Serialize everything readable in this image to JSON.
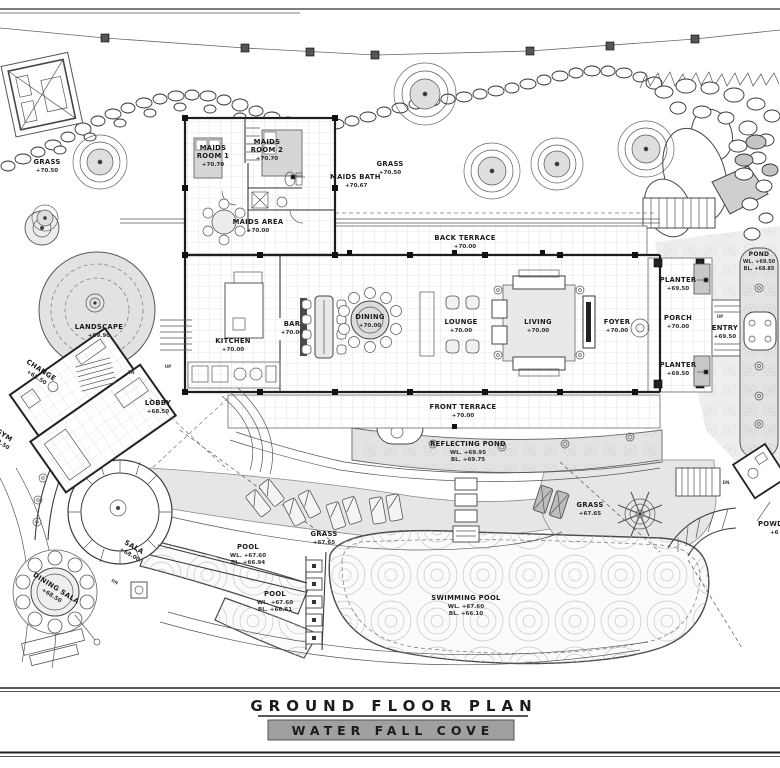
{
  "sheet": {
    "title": "GROUND FLOOR PLAN",
    "subtitle": "WATER FALL COVE"
  },
  "labels": {
    "grass_nw": {
      "name": "GRASS",
      "level": "+70.50"
    },
    "grass_n": {
      "name": "GRASS",
      "level": "+70.50"
    },
    "maids_room_1": {
      "line1": "MAIDS",
      "line2": "ROOM 1",
      "level": "+70.70"
    },
    "maids_room_2": {
      "line1": "MAIDS",
      "line2": "ROOM 2",
      "level": "+70.70"
    },
    "maids_bath": {
      "name": "MAIDS BATH",
      "level": "+70.67"
    },
    "maids_area": {
      "name": "MAIDS AREA",
      "level": "+70.00"
    },
    "back_terrace": {
      "name": "BACK TERRACE",
      "level": "+70.00"
    },
    "pond": {
      "name": "POND",
      "wl": "WL. +69.50",
      "bl": "BL. +68.85"
    },
    "planter_n": {
      "name": "PLANTER",
      "level": "+69.50"
    },
    "porch": {
      "name": "PORCH",
      "level": "+70.00"
    },
    "entry": {
      "name": "ENTRY",
      "level": "+69.50"
    },
    "planter_s": {
      "name": "PLANTER",
      "level": "+69.50"
    },
    "kitchen": {
      "name": "KITCHEN",
      "level": "+70.00"
    },
    "bar": {
      "name": "BAR",
      "level": "+70.00"
    },
    "dining": {
      "name": "DINING",
      "level": "+70.00"
    },
    "lounge": {
      "name": "LOUNGE",
      "level": "+70.00"
    },
    "living": {
      "name": "LIVING",
      "level": "+70.00"
    },
    "foyer": {
      "name": "FOYER",
      "level": "+70.00"
    },
    "landscape": {
      "name": "LANDSCAPE",
      "level": "+69.90"
    },
    "change": {
      "name": "CHANGE",
      "level": "+68.50"
    },
    "gym": {
      "name": "GYM",
      "level": "+68.50"
    },
    "lobby": {
      "name": "LOBBY",
      "level": "+68.50"
    },
    "front_terrace": {
      "name": "FRONT TERRACE",
      "level": "+70.00"
    },
    "reflecting_pond": {
      "name": "REFLECTING POND",
      "wl": "WL. +69.95",
      "bl": "BL. +69.75"
    },
    "grass_w": {
      "name": "GRASS",
      "level": "+67.65"
    },
    "grass_e": {
      "name": "GRASS",
      "level": "+67.65"
    },
    "pool_upper": {
      "name": "POOL",
      "wl": "WL. +67.60",
      "bl": "BL. +66.94"
    },
    "pool_lower": {
      "name": "POOL",
      "wl": "WL. +67.60",
      "bl": "BL. +66.61"
    },
    "sala": {
      "name": "SALA",
      "level": "+68.00"
    },
    "dining_sala": {
      "name": "DINING SALA",
      "level": "+68.50"
    },
    "swimming_pool": {
      "name": "SWIMMING POOL",
      "wl": "WL. +67.60",
      "bl": "BL. +66.10"
    },
    "powder": {
      "name": "POWDER",
      "level": "+6"
    }
  },
  "annotations": {
    "up": "UP",
    "dn": "DN"
  },
  "colors": {
    "ink": "#1e1e1e",
    "grass_fill": "#e6e6e6",
    "water_fill": "#e3e3e3",
    "subtitle_bg": "#a0a0a0"
  }
}
